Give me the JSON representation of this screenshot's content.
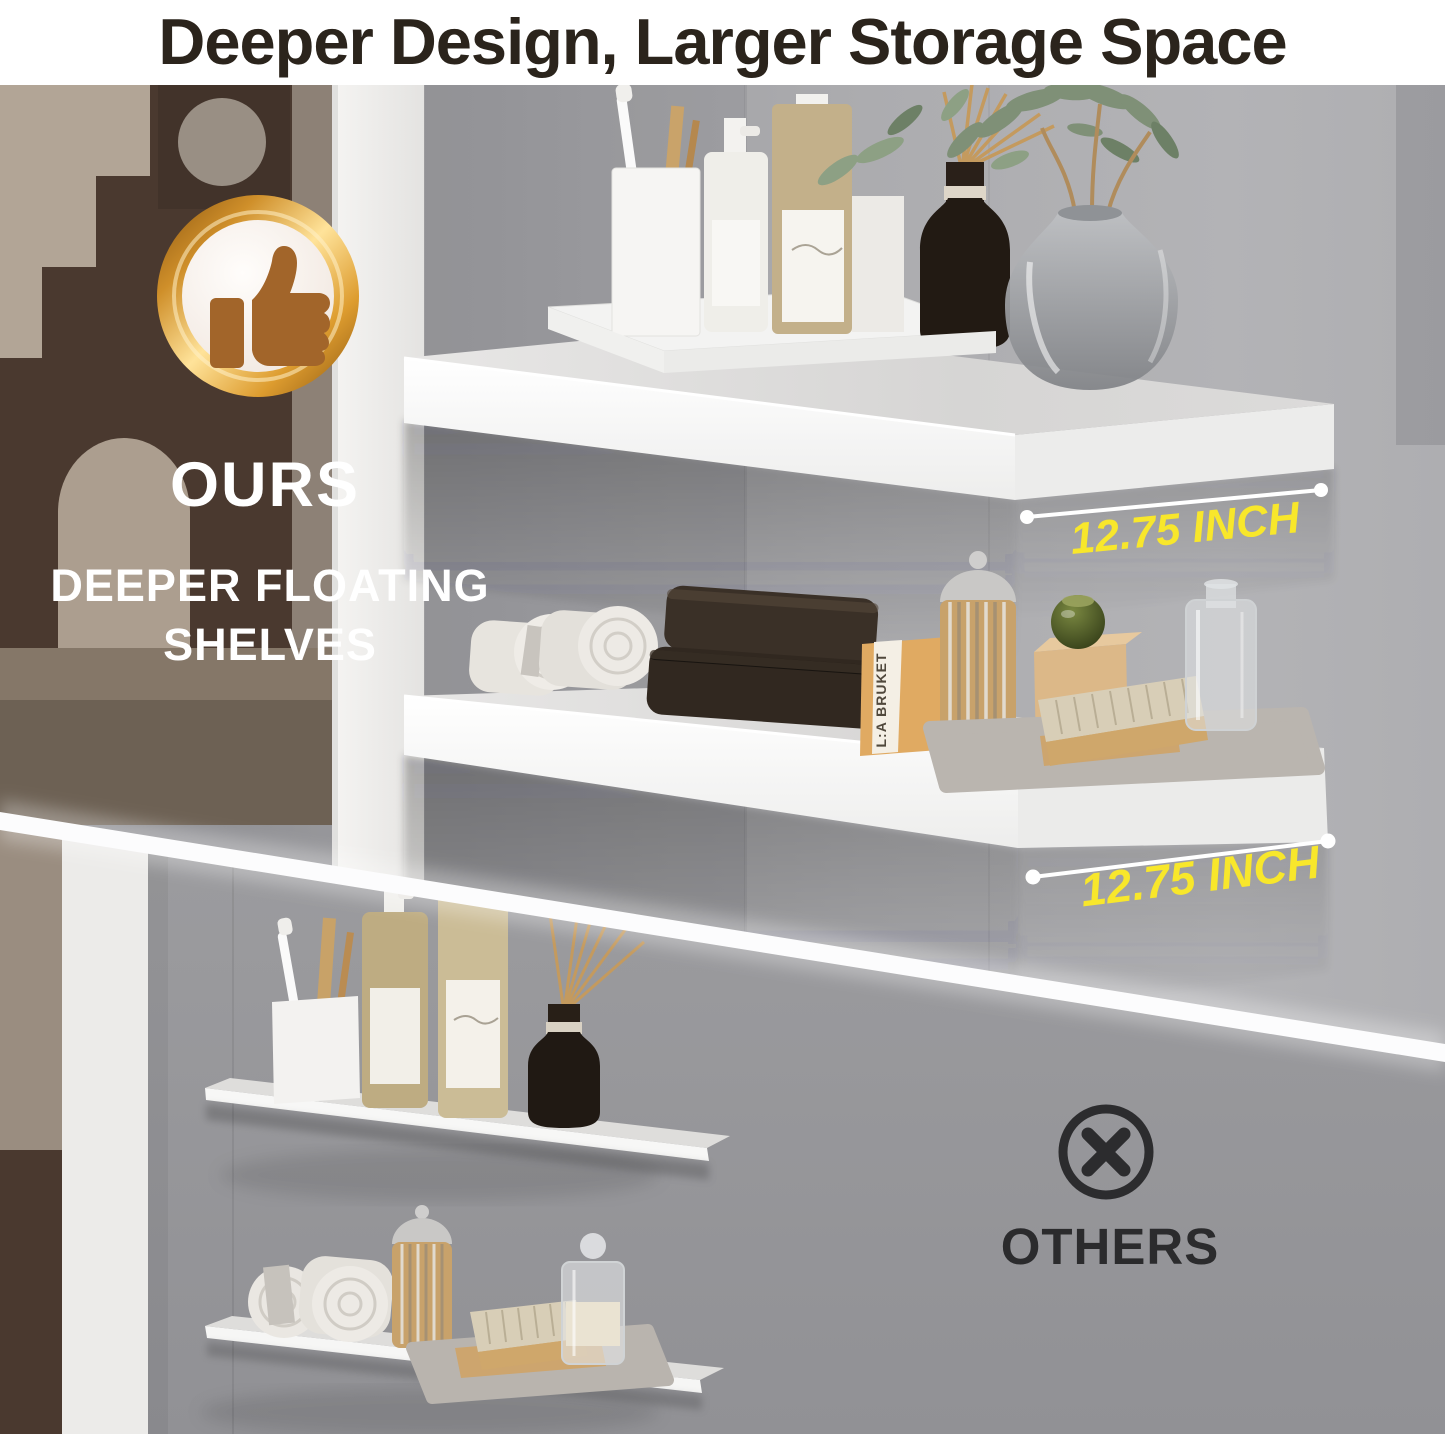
{
  "header": {
    "title": "Deeper Design, Larger Storage Space"
  },
  "ours": {
    "label": "OURS",
    "subtitle_line1": "DEEPER FLOATING",
    "subtitle_line2": "SHELVES",
    "badge_icon": "thumbs-up",
    "measurements": [
      {
        "value": "12.75 INCH"
      },
      {
        "value": "12.75 INCH"
      }
    ]
  },
  "others": {
    "label": "OTHERS",
    "icon": "cross-circle"
  },
  "props": {
    "soap_box_brand": "L:A BRUKET"
  },
  "colors": {
    "title_text": "#2b241c",
    "accent_yellow": "#f8e72b",
    "measure_line": "#ffffff",
    "badge_gold": "#e0a13c",
    "thumb_brown": "#a2652a",
    "wall_gray_ours": "#a7a7aa",
    "wall_gray_others": "#97979a",
    "shelf_white": "#f6f6f5",
    "others_icon_dark": "#2c2c2e"
  }
}
